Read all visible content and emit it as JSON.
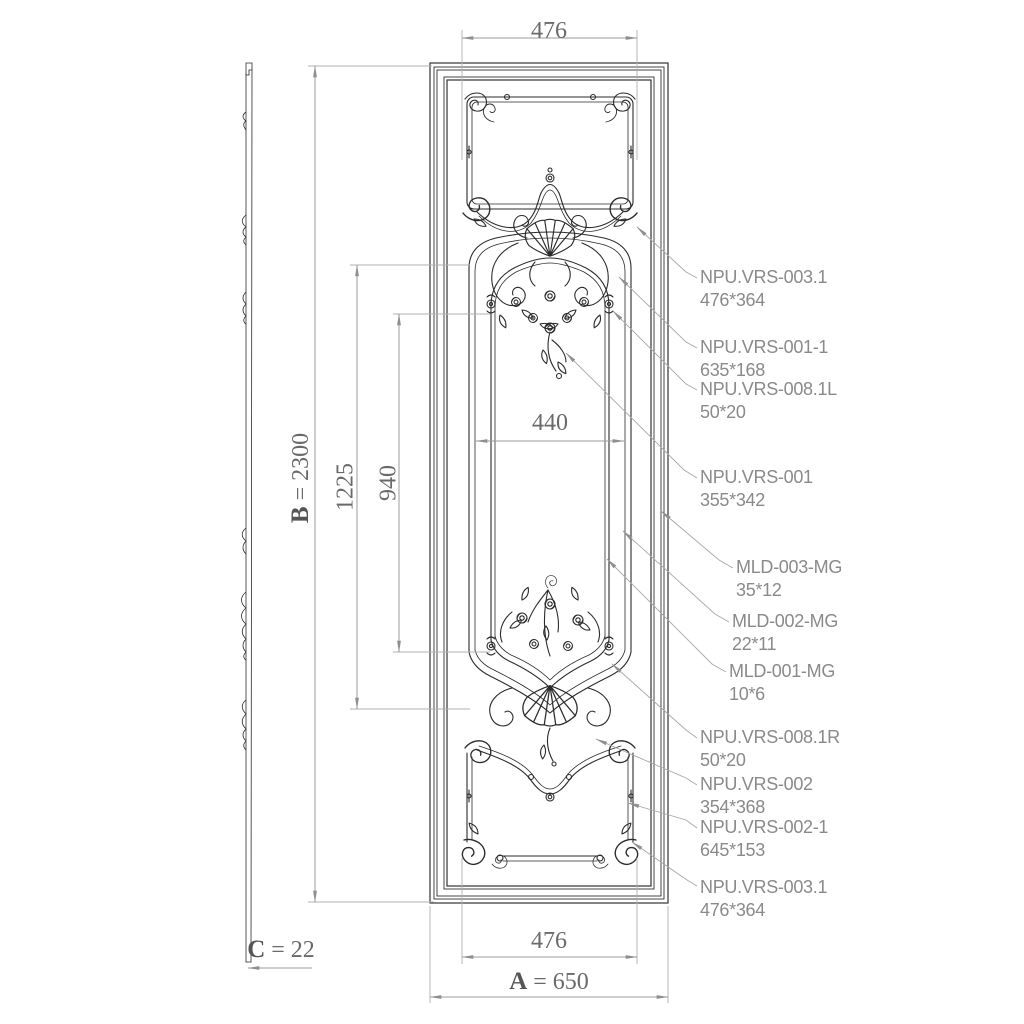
{
  "drawing": {
    "colors": {
      "background": "#ffffff",
      "ornament_line": "#2b2b2b",
      "dimension_line": "#9b9b9b",
      "dimension_text": "#6a6a6a",
      "callout_text": "#8a8a8a"
    },
    "dimensions": {
      "top_width": "476",
      "bottom_width": "476",
      "inner_width": "440",
      "inner_height_outer": "1225",
      "inner_height_inner": "940",
      "height_letter": "B",
      "height_value": "= 2300",
      "width_letter": "A",
      "width_value": "= 650",
      "thickness_letter": "C",
      "thickness_value": "= 22"
    },
    "callouts": {
      "items": [
        {
          "name": "NPU.VRS-003.1",
          "size": "476*364"
        },
        {
          "name": "NPU.VRS-001-1",
          "size": "635*168"
        },
        {
          "name": "NPU.VRS-008.1L",
          "size": "50*20"
        },
        {
          "name": "NPU.VRS-001",
          "size": "355*342"
        },
        {
          "name": "MLD-003-MG",
          "size": "35*12"
        },
        {
          "name": "MLD-002-MG",
          "size": "22*11"
        },
        {
          "name": "MLD-001-MG",
          "size": "10*6"
        },
        {
          "name": "NPU.VRS-008.1R",
          "size": "50*20"
        },
        {
          "name": "NPU.VRS-002",
          "size": "354*368"
        },
        {
          "name": "NPU.VRS-002-1",
          "size": "645*153"
        },
        {
          "name": "NPU.VRS-003.1",
          "size": "476*364"
        }
      ]
    }
  }
}
